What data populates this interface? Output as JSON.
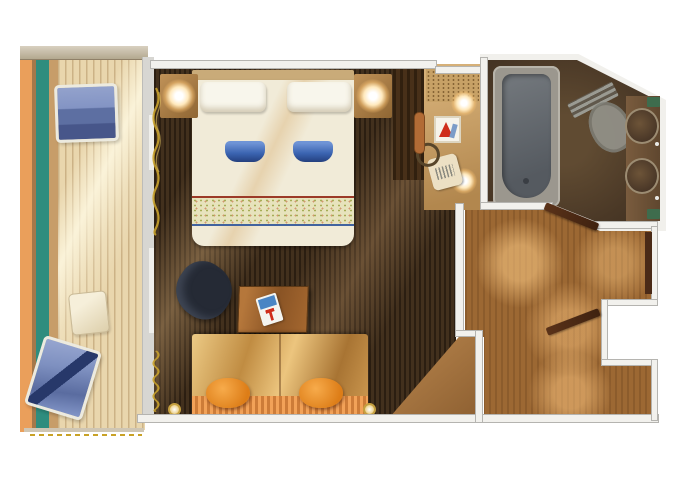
{
  "scene": {
    "type": "floor-plan",
    "subject": "cruise ship balcony stateroom floor plan",
    "width_px": 680,
    "height_px": 486
  },
  "palette": {
    "background": "#ffffff",
    "walls": "#f2f1ed",
    "wall_edge": "#b5b4b0",
    "balcony_deck": "#e9d6ad",
    "balcony_stripe_orange": "#ea9f5b",
    "balcony_stripe_teal": "#2f8d7e",
    "cabin_floor_dark_wood": "#42301d",
    "hallway_floor_wood": "#9c6833",
    "bathroom_floor": "#4a3826",
    "bed_linen_cream": "#f1ebd8",
    "accent_blue": "#3a63b0",
    "sofa_orange": "#dd7d17",
    "lounger_blue": "#7e90c0",
    "bathtub_gray": "#70757a",
    "gold_trim": "#c9a22c",
    "towel_green": "#3e6c4d",
    "door_wood": "#4a2a17"
  },
  "rooms": {
    "balcony": {
      "label": "Balcony",
      "furniture": [
        "lounge chair",
        "lounge chair",
        "side table"
      ]
    },
    "bedroom": {
      "label": "Stateroom",
      "furniture": [
        "double bed with blue towels",
        "nightstand with lamp",
        "nightstand with lamp",
        "wardrobe",
        "desk with magazine",
        "armchair",
        "sofa with orange pillows",
        "vanity with two lamps, picture and handbag",
        "vanity stool"
      ]
    },
    "bathroom": {
      "label": "Bathroom",
      "furniture": [
        "bathtub",
        "toilet",
        "double sink vanity",
        "green towels"
      ]
    },
    "hallway": {
      "label": "Entry hallway",
      "furniture": [
        "bathroom door",
        "entry door",
        "closet door"
      ]
    }
  }
}
